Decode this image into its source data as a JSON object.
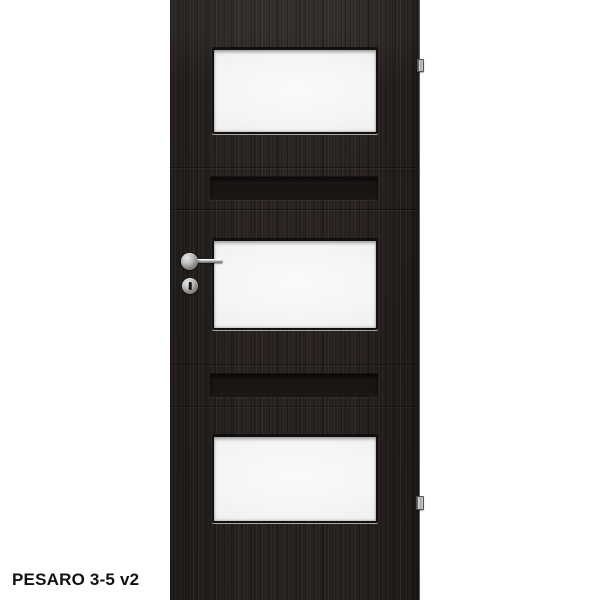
{
  "product": {
    "caption": "PESARO 3-5 v2"
  },
  "image": {
    "type": "product-photo",
    "subject": "interior door, dark wenge wood finish, cropped at top and bottom",
    "glass_panel_count": 3,
    "groove_count": 2,
    "hinge_count": 2,
    "hardware": [
      "door-handle",
      "key-lock-rosette"
    ]
  },
  "colors": {
    "background": "#ffffff",
    "wood": "#28221f",
    "groove": "#191514",
    "glass": "#f5f5f5",
    "glass_edge": "#e3e3e3",
    "frame": "#131010",
    "chrome": "#b9b9b9",
    "caption_text": "#111111"
  }
}
